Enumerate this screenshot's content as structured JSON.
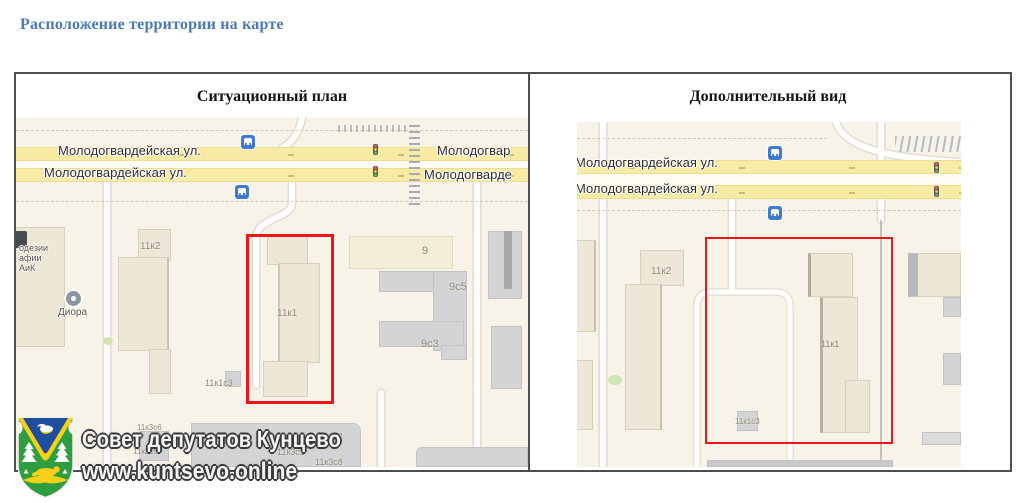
{
  "page": {
    "title": "Расположение территории на карте"
  },
  "panels": [
    {
      "title": "Ситуационный план"
    },
    {
      "title": "Дополнительный вид"
    }
  ],
  "watermark": {
    "org": "Совет депутатов Кунцево",
    "site": "www.kuntsevo.online"
  },
  "icons": {
    "bus_stop": "bus-stop-icon",
    "traffic_light": "traffic-light-icon",
    "poi": "poi-dot-icon",
    "emblem": "kuntsevo-coat-of-arms"
  },
  "colors": {
    "title_blue": "#4a79b5",
    "highlight_red": "#f01414",
    "road_yellow": "#f8eba4",
    "bus_icon_blue": "#3f7ad1",
    "map_bg": "#f7f3e9",
    "shield_green": "#2f9e41",
    "shield_blue": "#1e4e9e",
    "shield_yellow": "#f7d117"
  },
  "maps": [
    {
      "name": "Ситуационный план",
      "street_labels": [
        {
          "text": "Молодогвардейская ул.",
          "x": 42,
          "y": 26
        },
        {
          "text": "Молодогвардейская ул.",
          "x": 28,
          "y": 48
        },
        {
          "text": "Молодогвар",
          "x": 421,
          "y": 26
        },
        {
          "text": "Молодогварде",
          "x": 408,
          "y": 50
        }
      ],
      "building_labels": [
        {
          "text": "11к2",
          "x": 124,
          "y": 124,
          "size": 10
        },
        {
          "text": "11к1",
          "x": 261,
          "y": 191,
          "size": 10
        },
        {
          "text": "9",
          "x": 406,
          "y": 128,
          "size": 11
        },
        {
          "text": "9с5",
          "x": 433,
          "y": 164,
          "size": 11
        },
        {
          "text": "9с3",
          "x": 405,
          "y": 221,
          "size": 11
        },
        {
          "text": "11к1с3",
          "x": 189,
          "y": 261,
          "size": 9
        },
        {
          "text": "11к3с6",
          "x": 121,
          "y": 306,
          "size": 8
        },
        {
          "text": "11к3с5",
          "x": 117,
          "y": 330,
          "size": 8
        },
        {
          "text": "11к3с7",
          "x": 299,
          "y": 315,
          "size": 9
        },
        {
          "text": "11к3с1",
          "x": 261,
          "y": 330,
          "size": 9
        },
        {
          "text": "11к3с8",
          "x": 299,
          "y": 340,
          "size": 9
        }
      ],
      "poi_labels": [
        {
          "text": "одезии",
          "x": 3,
          "y": 126,
          "size": 9
        },
        {
          "text": "афии",
          "x": 3,
          "y": 136,
          "size": 9
        },
        {
          "text": "АиК",
          "x": 3,
          "y": 146,
          "size": 9
        },
        {
          "text": "Диора",
          "x": 42,
          "y": 190,
          "size": 10
        }
      ]
    },
    {
      "name": "Дополнительный вид",
      "street_labels": [
        {
          "text": "Молодогвардейская ул.",
          "x": -2,
          "y": 33
        },
        {
          "text": "Молодогвардейская ул.",
          "x": -2,
          "y": 59
        }
      ],
      "building_labels": [
        {
          "text": "11к2",
          "x": 74,
          "y": 144,
          "size": 10
        },
        {
          "text": "11к1",
          "x": 244,
          "y": 217,
          "size": 9
        },
        {
          "text": "11к1с3",
          "x": 158,
          "y": 295,
          "size": 8
        }
      ],
      "poi_labels": []
    }
  ]
}
